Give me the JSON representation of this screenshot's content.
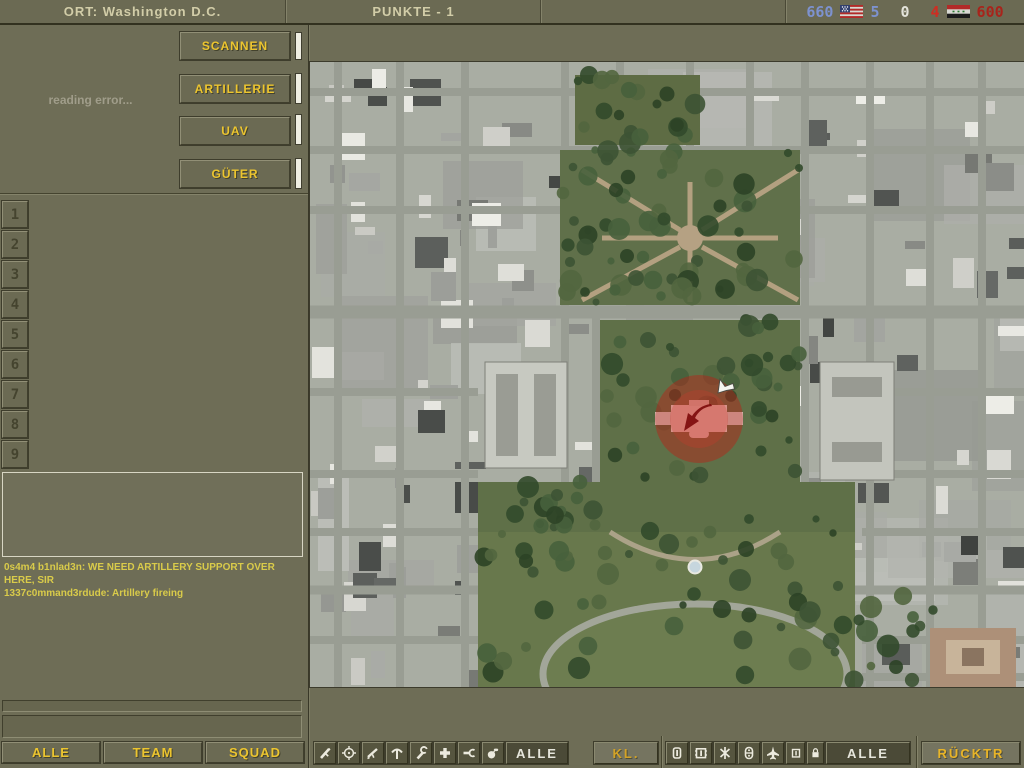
{
  "top_bar": {
    "ort": "ORT: Washington D.C.",
    "punkte": "PUNKTE - 1",
    "score_left": "660",
    "tickets_left": "5",
    "score_mid": "0",
    "tickets_right": "4",
    "score_right": "600",
    "flag_left": "us-flag",
    "flag_right": "iraq-flag",
    "colors": {
      "us_side": "#7d92cf",
      "neutral": "#e3e3da",
      "iraq_side": "#cf2d22"
    }
  },
  "commander_panel": {
    "status_text": "reading error...",
    "actions": [
      {
        "label": "SCANNEN"
      },
      {
        "label": "ARTILLERIE"
      },
      {
        "label": "UAV"
      },
      {
        "label": "GÜTER"
      }
    ],
    "slots": [
      "1",
      "2",
      "3",
      "4",
      "5",
      "6",
      "7",
      "8",
      "9"
    ]
  },
  "chat": {
    "messages": [
      "0s4m4 b1nlad3n: WE NEED ARTILLERY SUPPORT OVER HERE, SIR",
      "1337c0mmand3rdude: Artillery fireing"
    ],
    "input_value": "",
    "channels": [
      {
        "label": "ALLE"
      },
      {
        "label": "TEAM"
      },
      {
        "label": "SQUAD"
      }
    ]
  },
  "toolbar": {
    "kit_filter": {
      "icons": [
        "rifle",
        "sniper-scope",
        "carbine",
        "pickaxe",
        "wrench",
        "medic-cross",
        "spanner",
        "grenade"
      ],
      "all_label": "ALLE",
      "class_label": "KL."
    },
    "vehicle_filter": {
      "icons": [
        "soldier",
        "tank",
        "infantry",
        "apc",
        "aircraft",
        "artillery",
        "lock"
      ],
      "all_label": "ALLE"
    },
    "back_label": "RÜCKTR"
  },
  "map": {
    "location": "Washington D.C.",
    "marker": "artillery-target",
    "marker_color": "#c01a14"
  }
}
